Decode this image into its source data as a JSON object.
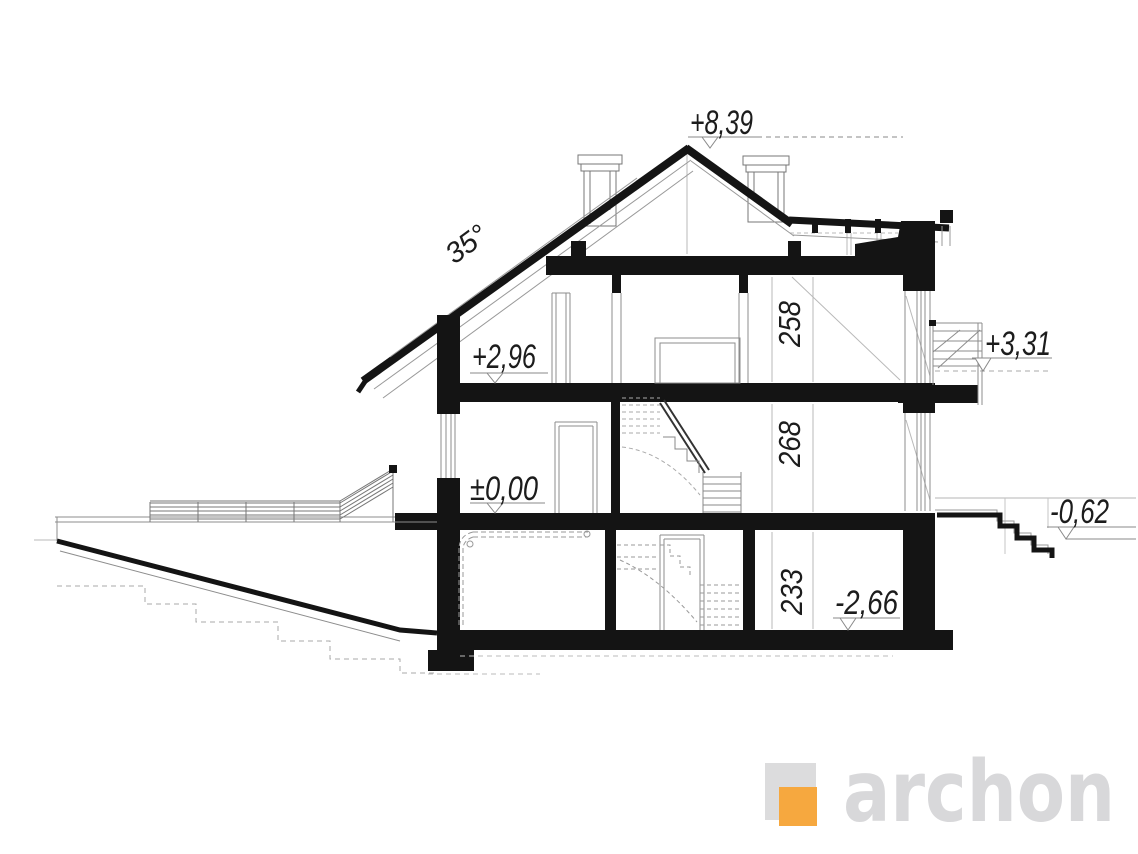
{
  "drawing": {
    "roof_angle": "35°",
    "levels": {
      "ridge": "+8,39",
      "attic_floor": "+2,96",
      "balcony": "+3,31",
      "ground_floor": "±0,00",
      "terrace": "-0,62",
      "basement_floor": "-2,66"
    },
    "room_heights": {
      "attic": "258",
      "ground_floor": "268",
      "basement": "233"
    },
    "logo": {
      "text": "archon",
      "orange": "#F6A83F",
      "gray": "#D8D8DA"
    }
  }
}
